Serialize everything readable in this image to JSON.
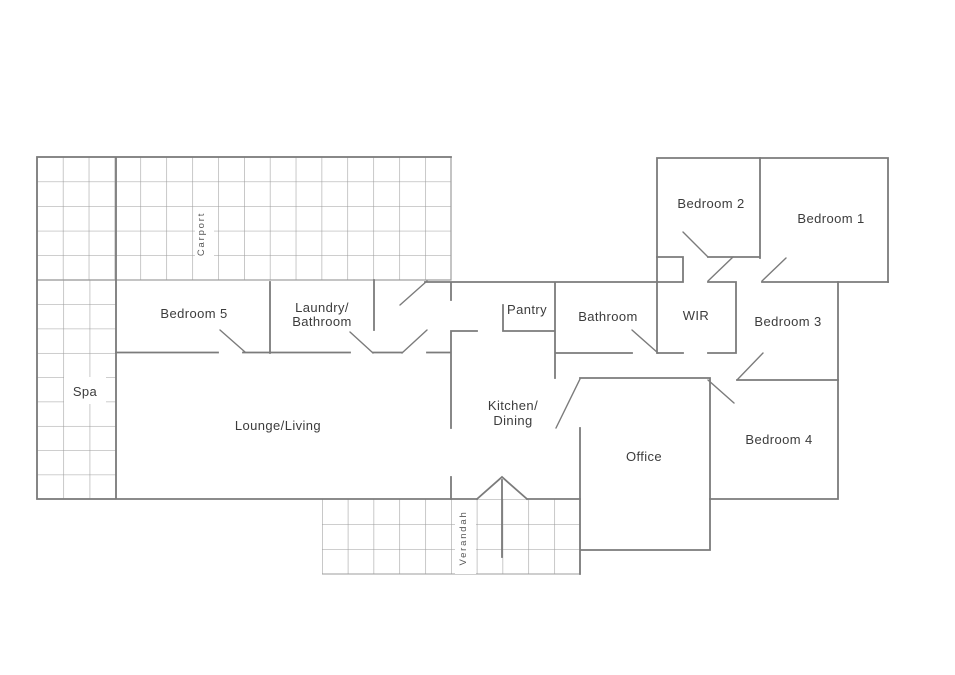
{
  "colors": {
    "wall": "#7b7b7b",
    "grid": "#9c9c9c",
    "text": "#3c3c3c",
    "bg": "#ffffff"
  },
  "rooms": {
    "bedroom1": {
      "label": "Bedroom 1"
    },
    "bedroom2": {
      "label": "Bedroom 2"
    },
    "bedroom3": {
      "label": "Bedroom 3"
    },
    "bedroom4": {
      "label": "Bedroom 4"
    },
    "bedroom5": {
      "label": "Bedroom 5"
    },
    "bathroom": {
      "label": "Bathroom"
    },
    "wir": {
      "label": "WIR"
    },
    "pantry": {
      "label": "Pantry"
    },
    "laundry": {
      "line1": "Laundry/",
      "line2": "Bathroom"
    },
    "kitchen": {
      "line1": "Kitchen/",
      "line2": "Dining"
    },
    "lounge": {
      "label": "Lounge/Living"
    },
    "office": {
      "label": "Office"
    },
    "spa": {
      "label": "Spa"
    },
    "carport": {
      "label": "Carport"
    },
    "verandah": {
      "label": "Verandah"
    }
  }
}
